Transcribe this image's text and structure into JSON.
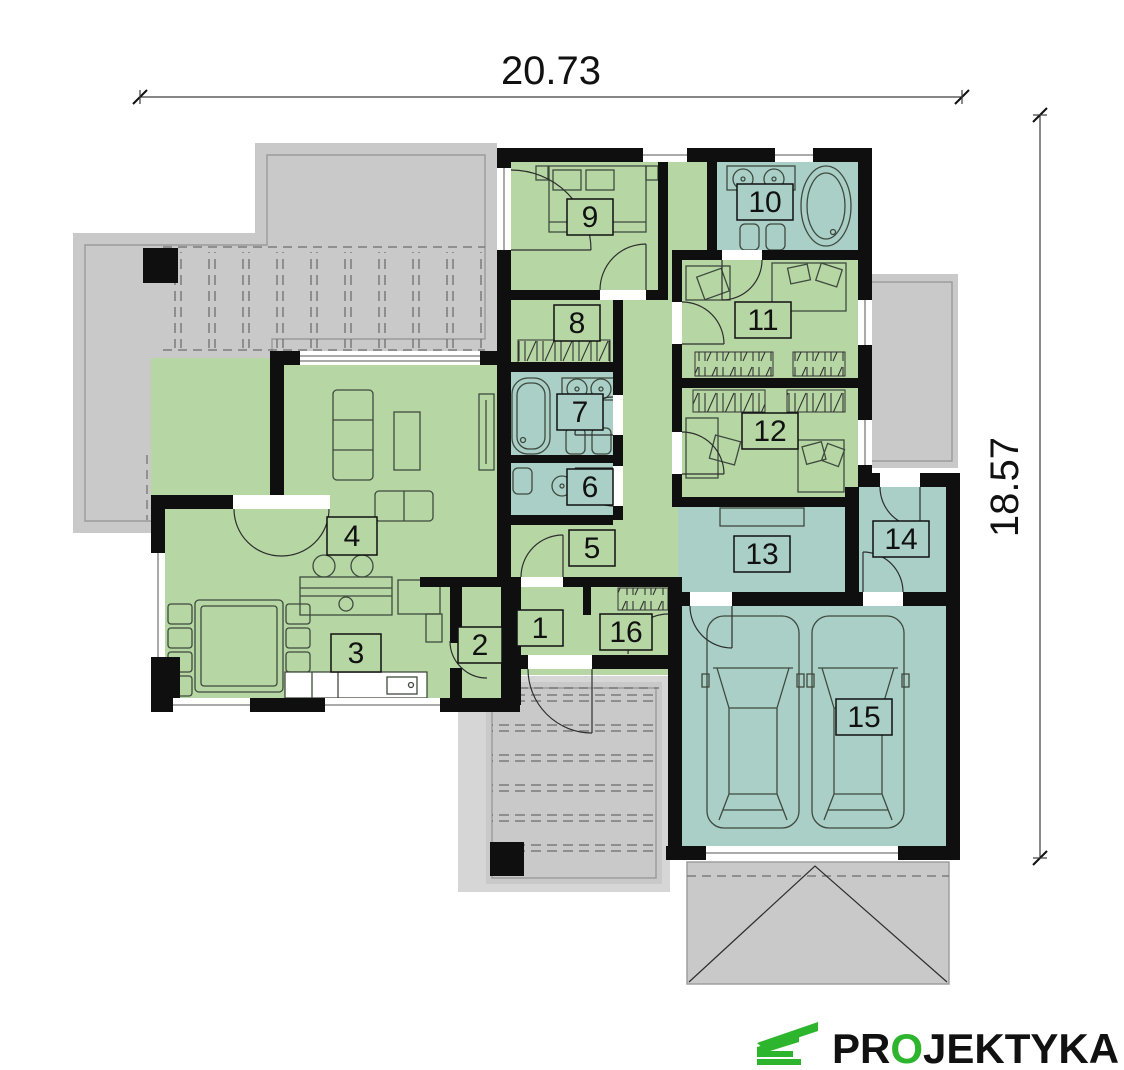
{
  "plan": {
    "dimensions": {
      "top": "20.73",
      "right": "18.57"
    },
    "rooms": [
      {
        "number": "1"
      },
      {
        "number": "2"
      },
      {
        "number": "3"
      },
      {
        "number": "4"
      },
      {
        "number": "5"
      },
      {
        "number": "6"
      },
      {
        "number": "7"
      },
      {
        "number": "8"
      },
      {
        "number": "9"
      },
      {
        "number": "10"
      },
      {
        "number": "11"
      },
      {
        "number": "12"
      },
      {
        "number": "13"
      },
      {
        "number": "14"
      },
      {
        "number": "15"
      },
      {
        "number": "16"
      }
    ],
    "colors": {
      "room_living": "#b6d7a4",
      "room_wet": "#a9cfc6",
      "terrace": "#c9c9c9",
      "terrace_light": "#d6d6d6",
      "wall": "#0f0f0f",
      "logo_green": "#2db52d"
    },
    "logo": {
      "pre": "PR",
      "o": "O",
      "post": "JEKTYKA"
    }
  }
}
